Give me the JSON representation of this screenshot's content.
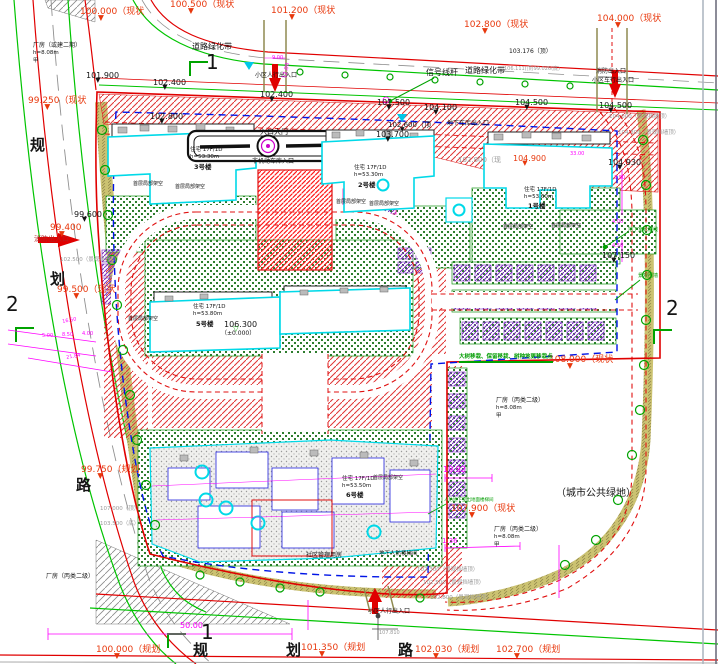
{
  "colors": {
    "r": "#e8380d",
    "k": "#141414",
    "g": "#9a9a9a",
    "m": "#ff00ff",
    "gr": "#009c00",
    "dr": "#b22222"
  },
  "labels": [
    {
      "t": "100.000（现状",
      "x": 80,
      "y": 8,
      "c": "r",
      "s": 9,
      "tri": "r",
      "n": "spot-elevation"
    },
    {
      "t": "100.500（现状",
      "x": 170,
      "y": 1,
      "c": "r",
      "s": 9,
      "tri": "r",
      "n": "spot-elevation"
    },
    {
      "t": "101.200（现状",
      "x": 271,
      "y": 7,
      "c": "r",
      "s": 9,
      "tri": "r",
      "n": "spot-elevation"
    },
    {
      "t": "102.800（现状",
      "x": 464,
      "y": 21,
      "c": "r",
      "s": 9,
      "tri": "r",
      "n": "spot-elevation"
    },
    {
      "t": "104.000（现状",
      "x": 597,
      "y": 15,
      "c": "r",
      "s": 9,
      "tri": "r",
      "n": "spot-elevation"
    },
    {
      "t": "99.250（现状",
      "x": 28,
      "y": 97,
      "c": "r",
      "s": 9,
      "tri": "r",
      "n": "spot-elevation"
    },
    {
      "t": "99.400",
      "x": 50,
      "y": 224,
      "c": "r",
      "s": 9,
      "tri": "r",
      "n": "spot-elevation"
    },
    {
      "t": "99.500（现状",
      "x": 57,
      "y": 286,
      "c": "r",
      "s": 9,
      "tri": "r",
      "n": "spot-elevation"
    },
    {
      "t": "99.750（规划",
      "x": 81,
      "y": 466,
      "c": "r",
      "s": 9,
      "tri": "r",
      "n": "spot-elevation"
    },
    {
      "t": "108.000（现状",
      "x": 549,
      "y": 356,
      "c": "r",
      "s": 9,
      "tri": "r",
      "n": "spot-elevation"
    },
    {
      "t": "107.900（现状",
      "x": 451,
      "y": 505,
      "c": "r",
      "s": 9,
      "tri": "r",
      "n": "spot-elevation"
    },
    {
      "t": "100.000（规划",
      "x": 96,
      "y": 646,
      "c": "r",
      "s": 9,
      "tri": "r",
      "n": "spot-elevation"
    },
    {
      "t": "101.350（规划",
      "x": 301,
      "y": 644,
      "c": "r",
      "s": 9,
      "tri": "r",
      "n": "spot-elevation"
    },
    {
      "t": "102.030（规划",
      "x": 415,
      "y": 646,
      "c": "r",
      "s": 9,
      "tri": "r",
      "n": "spot-elevation"
    },
    {
      "t": "102.700（规划",
      "x": 496,
      "y": 646,
      "c": "r",
      "s": 9,
      "tri": "r",
      "n": "spot-elevation"
    },
    {
      "t": "104.900",
      "x": 513,
      "y": 155,
      "c": "r",
      "s": 8,
      "tri": "r",
      "n": "spot-elevation"
    },
    {
      "t": "101.900",
      "x": 86,
      "y": 72,
      "c": "k",
      "s": 8,
      "tri": "k",
      "n": "spot-elevation"
    },
    {
      "t": "102.400",
      "x": 153,
      "y": 79,
      "c": "k",
      "s": 8,
      "tri": "k",
      "n": "spot-elevation"
    },
    {
      "t": "102.400",
      "x": 260,
      "y": 91,
      "c": "k",
      "s": 8,
      "tri": "k",
      "n": "spot-elevation"
    },
    {
      "t": "101.500",
      "x": 377,
      "y": 99,
      "c": "k",
      "s": 8,
      "tri": "k",
      "n": "spot-elevation"
    },
    {
      "t": "104.100",
      "x": 424,
      "y": 104,
      "c": "k",
      "s": 8,
      "tri": "k",
      "n": "spot-elevation"
    },
    {
      "t": "104.500",
      "x": 515,
      "y": 99,
      "c": "k",
      "s": 8,
      "tri": "k",
      "n": "spot-elevation"
    },
    {
      "t": "104.500",
      "x": 599,
      "y": 102,
      "c": "k",
      "s": 8,
      "tri": "k",
      "n": "spot-elevation"
    },
    {
      "t": "102.800",
      "x": 150,
      "y": 113,
      "c": "k",
      "s": 8,
      "tri": "k",
      "n": "spot-elevation"
    },
    {
      "t": "102.600（顶",
      "x": 388,
      "y": 122,
      "c": "k",
      "s": 7,
      "tri": "k",
      "n": "spot-elevation"
    },
    {
      "t": "103.700",
      "x": 376,
      "y": 131,
      "c": "k",
      "s": 8,
      "tri": "k",
      "n": "spot-elevation"
    },
    {
      "t": "104.930",
      "x": 608,
      "y": 159,
      "c": "k",
      "s": 8,
      "tri": "k",
      "n": "spot-elevation"
    },
    {
      "t": "99.600",
      "x": 74,
      "y": 211,
      "c": "k",
      "s": 8,
      "tri": "k",
      "n": "spot-elevation"
    },
    {
      "t": "106.300",
      "x": 224,
      "y": 321,
      "c": "k",
      "s": 8,
      "tri": "o",
      "n": "spot-elevation"
    },
    {
      "t": "（±0.000）",
      "x": 221,
      "y": 331,
      "c": "k",
      "s": 6,
      "n": "spot-elevation"
    },
    {
      "t": "107.150",
      "x": 602,
      "y": 252,
      "c": "k",
      "s": 8,
      "tri": "k",
      "n": "spot-elevation"
    },
    {
      "t": "102.800（现",
      "x": 458,
      "y": 157,
      "c": "g",
      "s": 7,
      "n": "spot-elevation"
    },
    {
      "t": "103.176（顶）",
      "x": 509,
      "y": 49,
      "c": "k",
      "s": 6,
      "n": "spot-elevation"
    },
    {
      "t": "106.111(顶)99.026(底)",
      "x": 504,
      "y": 67,
      "c": "g",
      "s": 5,
      "n": "spot-elevation"
    },
    {
      "t": "107.810",
      "x": 379,
      "y": 631,
      "c": "g",
      "s": 5,
      "n": "spot-elevation"
    },
    {
      "t": "102.500（景观挡墙顶）",
      "x": 60,
      "y": 258,
      "c": "g",
      "s": 5.5,
      "n": "wall-top-elevation"
    },
    {
      "t": "107.000（顶）",
      "x": 100,
      "y": 507,
      "c": "g",
      "s": 5.5,
      "n": "wall-top-elevation"
    },
    {
      "t": "103.500（底）",
      "x": 100,
      "y": 522,
      "c": "g",
      "s": 5.5,
      "n": "wall-top-elevation"
    },
    {
      "t": "104.000（景观挡墙顶）",
      "x": 609,
      "y": 115,
      "c": "g",
      "s": 5.5,
      "n": "wall-top-elevation"
    },
    {
      "t": "104.300（景观挡墙顶）",
      "x": 618,
      "y": 131,
      "c": "g",
      "s": 5.5,
      "n": "wall-top-elevation"
    },
    {
      "t": "102.300（景观挡墙顶）",
      "x": 417,
      "y": 568,
      "c": "g",
      "s": 5.5,
      "n": "wall-top-elevation"
    },
    {
      "t": "102.500（景观挡墙顶）",
      "x": 423,
      "y": 581,
      "c": "g",
      "s": 5.5,
      "n": "wall-top-elevation"
    },
    {
      "t": "102.800（景观挡墙顶）",
      "x": 430,
      "y": 596,
      "c": "g",
      "s": 5.5,
      "n": "wall-top-elevation"
    },
    {
      "t": "道路绿化带",
      "x": 192,
      "y": 43,
      "c": "k",
      "s": 8,
      "n": "road-greenbelt-label"
    },
    {
      "t": "道路绿化带",
      "x": 465,
      "y": 67,
      "c": "k",
      "s": 8,
      "n": "road-greenbelt-label"
    },
    {
      "t": "信号线杆",
      "x": 426,
      "y": 69,
      "c": "k",
      "s": 8,
      "n": "signal-pole-label"
    },
    {
      "t": "小区人行出入口",
      "x": 255,
      "y": 73,
      "c": "k",
      "s": 6,
      "n": "pedestrian-entrance-label"
    },
    {
      "t": "消防出入口",
      "x": 596,
      "y": 69,
      "c": "k",
      "s": 6,
      "n": "fire-entrance-label"
    },
    {
      "t": "小区车行出入口",
      "x": 592,
      "y": 78,
      "c": "k",
      "s": 6,
      "n": "vehicle-entrance-label"
    },
    {
      "t": "入口大门",
      "x": 260,
      "y": 129,
      "c": "k",
      "s": 7,
      "n": "entrance-gate-label"
    },
    {
      "t": "非机动车库入口",
      "x": 252,
      "y": 159,
      "c": "k",
      "s": 6,
      "n": "bike-garage-label"
    },
    {
      "t": "地下车库出入口",
      "x": 447,
      "y": 121,
      "c": "k",
      "s": 6,
      "n": "garage-entrance-label"
    },
    {
      "t": "小区人行出入口",
      "x": 368,
      "y": 609,
      "c": "k",
      "s": 6,
      "n": "pedestrian-entrance-label"
    },
    {
      "t": "社区管理用房",
      "x": 306,
      "y": 553,
      "c": "k",
      "s": 6,
      "n": "community-room-label"
    },
    {
      "t": "地下人防楼梯间",
      "x": 379,
      "y": 552,
      "c": "k",
      "s": 5.5,
      "n": "stair-label"
    },
    {
      "t": "（城市公共绿地）",
      "x": 556,
      "y": 489,
      "c": "k",
      "s": 10,
      "n": "public-green-label"
    },
    {
      "t": "消防出入口",
      "x": 34,
      "y": 236,
      "c": "dr",
      "s": 7,
      "n": "fire-entrance-label"
    },
    {
      "t": "厂房（或建二期）",
      "x": 33,
      "y": 43,
      "c": "k",
      "s": 6,
      "n": "factory-label"
    },
    {
      "t": "h=8.08m",
      "x": 33,
      "y": 51,
      "c": "k",
      "s": 5.5,
      "n": "factory-label"
    },
    {
      "t": "甲",
      "x": 33,
      "y": 59,
      "c": "k",
      "s": 5.5,
      "n": "factory-label"
    },
    {
      "t": "厂房（丙类二级）",
      "x": 496,
      "y": 398,
      "c": "k",
      "s": 6,
      "n": "factory-label"
    },
    {
      "t": "h=8.08m",
      "x": 496,
      "y": 406,
      "c": "k",
      "s": 5.5,
      "n": "factory-label"
    },
    {
      "t": "甲",
      "x": 496,
      "y": 414,
      "c": "k",
      "s": 5.5,
      "n": "factory-label"
    },
    {
      "t": "厂房（丙类二级）",
      "x": 494,
      "y": 527,
      "c": "k",
      "s": 6,
      "n": "factory-label"
    },
    {
      "t": "h=8.08m",
      "x": 494,
      "y": 535,
      "c": "k",
      "s": 5.5,
      "n": "factory-label"
    },
    {
      "t": "甲",
      "x": 494,
      "y": 543,
      "c": "k",
      "s": 5.5,
      "n": "factory-label"
    },
    {
      "t": "厂房（丙类二级）",
      "x": 46,
      "y": 574,
      "c": "k",
      "s": 6,
      "n": "factory-label"
    },
    {
      "t": "住宅 17F/1D",
      "x": 190,
      "y": 148,
      "c": "k",
      "s": 5.5,
      "n": "building-info"
    },
    {
      "t": "h=53.30m",
      "x": 190,
      "y": 155,
      "c": "k",
      "s": 5.5,
      "n": "building-info"
    },
    {
      "t": "3号楼",
      "x": 194,
      "y": 164,
      "c": "k",
      "s": 6.5,
      "b": 1,
      "n": "building-number"
    },
    {
      "t": "住宅 17F/1D",
      "x": 354,
      "y": 166,
      "c": "k",
      "s": 5.5,
      "n": "building-info"
    },
    {
      "t": "h=53.30m",
      "x": 354,
      "y": 173,
      "c": "k",
      "s": 5.5,
      "n": "building-info"
    },
    {
      "t": "2号楼",
      "x": 358,
      "y": 182,
      "c": "k",
      "s": 6.5,
      "b": 1,
      "n": "building-number"
    },
    {
      "t": "住宅 17F/1D",
      "x": 524,
      "y": 188,
      "c": "k",
      "s": 5.5,
      "n": "building-info"
    },
    {
      "t": "h=53.60m",
      "x": 524,
      "y": 195,
      "c": "k",
      "s": 5.5,
      "n": "building-info"
    },
    {
      "t": "1号楼",
      "x": 528,
      "y": 203,
      "c": "k",
      "s": 6.5,
      "b": 1,
      "n": "building-number"
    },
    {
      "t": "住宅 17F/1D",
      "x": 193,
      "y": 305,
      "c": "k",
      "s": 5.5,
      "n": "building-info"
    },
    {
      "t": "h=53.80m",
      "x": 193,
      "y": 312,
      "c": "k",
      "s": 5.5,
      "n": "building-info"
    },
    {
      "t": "5号楼",
      "x": 196,
      "y": 321,
      "c": "k",
      "s": 6.5,
      "b": 1,
      "n": "building-number"
    },
    {
      "t": "住宅 17F/1D",
      "x": 342,
      "y": 477,
      "c": "k",
      "s": 5.5,
      "n": "building-info"
    },
    {
      "t": "h=53.50m",
      "x": 342,
      "y": 484,
      "c": "k",
      "s": 5.5,
      "n": "building-info"
    },
    {
      "t": "6号楼",
      "x": 346,
      "y": 492,
      "c": "k",
      "s": 6.5,
      "b": 1,
      "n": "building-number"
    },
    {
      "t": "首层局部架空",
      "x": 133,
      "y": 182,
      "c": "k",
      "s": 5,
      "n": "open-floor-label"
    },
    {
      "t": "首层局部架空",
      "x": 175,
      "y": 185,
      "c": "k",
      "s": 5,
      "n": "open-floor-label"
    },
    {
      "t": "首层局部架空",
      "x": 336,
      "y": 200,
      "c": "k",
      "s": 5,
      "n": "open-floor-label"
    },
    {
      "t": "首层局部架空",
      "x": 369,
      "y": 202,
      "c": "k",
      "s": 5,
      "n": "open-floor-label"
    },
    {
      "t": "首层局部架空",
      "x": 503,
      "y": 225,
      "c": "k",
      "s": 5,
      "n": "open-floor-label"
    },
    {
      "t": "首层局部架空",
      "x": 551,
      "y": 224,
      "c": "k",
      "s": 5,
      "n": "open-floor-label"
    },
    {
      "t": "首层局部架空",
      "x": 128,
      "y": 317,
      "c": "k",
      "s": 5,
      "n": "open-floor-label"
    },
    {
      "t": "首层局部架空",
      "x": 373,
      "y": 476,
      "c": "k",
      "s": 5,
      "n": "open-floor-label"
    },
    {
      "t": "大树移栽、保留移栽、树种地更移栽点",
      "x": 459,
      "y": 355,
      "c": "gr",
      "s": 5.5,
      "b": 1,
      "u": 1,
      "n": "tree-note"
    },
    {
      "t": "地下室轮廓线",
      "x": 628,
      "y": 228,
      "c": "gr",
      "s": 5,
      "n": "basement-outline-label"
    },
    {
      "t": "景观围墙",
      "x": 638,
      "y": 274,
      "c": "gr",
      "s": 5,
      "n": "landscape-wall-label"
    },
    {
      "t": "人防地下室出地面楼梯间",
      "x": 444,
      "y": 499,
      "c": "gr",
      "s": 4.5,
      "n": "stair-label"
    },
    {
      "t": "19.92",
      "x": 443,
      "y": 466,
      "c": "m",
      "s": 8,
      "n": "dimension"
    },
    {
      "t": "50.00",
      "x": 180,
      "y": 622,
      "c": "m",
      "s": 8,
      "n": "dimension"
    },
    {
      "t": "1.36",
      "x": 442,
      "y": 538,
      "c": "m",
      "s": 7,
      "n": "dimension"
    },
    {
      "t": "12.00",
      "x": 283,
      "y": 78,
      "c": "m",
      "s": 5.5,
      "rot": -78,
      "n": "dimension"
    },
    {
      "t": "9.00",
      "x": 272,
      "y": 56,
      "c": "m",
      "s": 5,
      "n": "dimension"
    },
    {
      "t": "16.50",
      "x": 62,
      "y": 320,
      "c": "m",
      "s": 5,
      "rot": -10,
      "n": "dimension"
    },
    {
      "t": "5.00",
      "x": 42,
      "y": 334,
      "c": "m",
      "s": 5,
      "n": "dimension"
    },
    {
      "t": "8.50",
      "x": 62,
      "y": 333,
      "c": "m",
      "s": 5,
      "n": "dimension"
    },
    {
      "t": "4.00",
      "x": 82,
      "y": 332,
      "c": "m",
      "s": 5,
      "n": "dimension"
    },
    {
      "t": "21.84",
      "x": 66,
      "y": 356,
      "c": "m",
      "s": 5,
      "rot": -10,
      "n": "dimension"
    },
    {
      "t": "33.00",
      "x": 570,
      "y": 152,
      "c": "m",
      "s": 5,
      "n": "dimension"
    },
    {
      "t": "3.50",
      "x": 614,
      "y": 176,
      "c": "m",
      "s": 5,
      "n": "dimension"
    },
    {
      "t": "4.00",
      "x": 612,
      "y": 220,
      "c": "m",
      "s": 5,
      "n": "dimension"
    },
    {
      "t": "4.50",
      "x": 612,
      "y": 244,
      "c": "m",
      "s": 5,
      "n": "dimension"
    },
    {
      "t": "规",
      "x": 30,
      "y": 138,
      "c": "k",
      "s": 15,
      "b": 1,
      "n": "road-name-char"
    },
    {
      "t": "划",
      "x": 50,
      "y": 272,
      "c": "k",
      "s": 15,
      "b": 1,
      "n": "road-name-char"
    },
    {
      "t": "路",
      "x": 76,
      "y": 478,
      "c": "k",
      "s": 15,
      "b": 1,
      "n": "road-name-char"
    },
    {
      "t": "规",
      "x": 193,
      "y": 643,
      "c": "k",
      "s": 15,
      "b": 1,
      "n": "road-name-char"
    },
    {
      "t": "划",
      "x": 286,
      "y": 643,
      "c": "k",
      "s": 15,
      "b": 1,
      "n": "road-name-char"
    },
    {
      "t": "路",
      "x": 398,
      "y": 643,
      "c": "k",
      "s": 15,
      "b": 1,
      "n": "road-name-char"
    },
    {
      "t": "1",
      "x": 206,
      "y": 52,
      "c": "k",
      "s": 20,
      "n": "section-marker"
    },
    {
      "t": "2",
      "x": 6,
      "y": 294,
      "c": "k",
      "s": 20,
      "n": "section-marker"
    },
    {
      "t": "2",
      "x": 666,
      "y": 298,
      "c": "k",
      "s": 20,
      "n": "section-marker"
    },
    {
      "t": "1",
      "x": 201,
      "y": 622,
      "c": "k",
      "s": 20,
      "n": "section-marker"
    }
  ]
}
